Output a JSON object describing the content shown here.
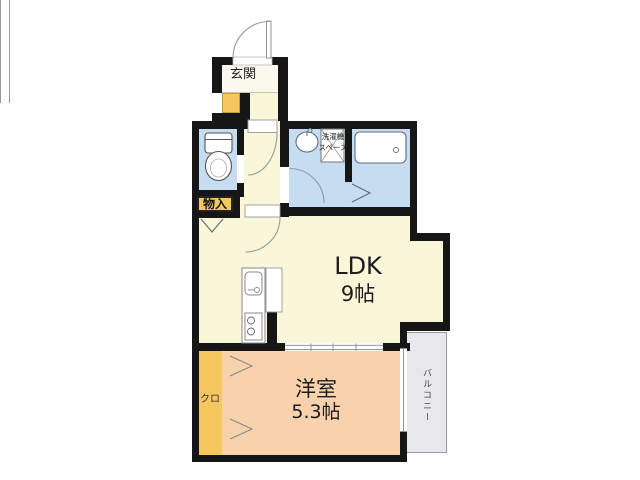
{
  "plan": {
    "type": "apartment-floorplan",
    "rooms": {
      "entrance": {
        "label": "玄関"
      },
      "ldk": {
        "name": "LDK",
        "size": "9帖"
      },
      "western_room": {
        "name": "洋室",
        "size": "5.3帖"
      },
      "closet": {
        "label": "クロ"
      },
      "storage": {
        "label": "物入"
      },
      "laundry_space": {
        "line1": "洗濯機",
        "line2": "スペース"
      },
      "balcony": {
        "label": "バルコニー"
      }
    },
    "fixtures": [
      "toilet",
      "washbasin",
      "bathtub",
      "kitchen-sink",
      "stove"
    ],
    "colors": {
      "wall": "#161616",
      "floor_cream": "#f9f6da",
      "wet_area_blue": "#c6dcf1",
      "western_room_peach": "#f8d2ad",
      "closet_orange": "#f6c75f",
      "balcony_gray": "#e8e8ec",
      "fixture_white": "#ffffff"
    }
  }
}
